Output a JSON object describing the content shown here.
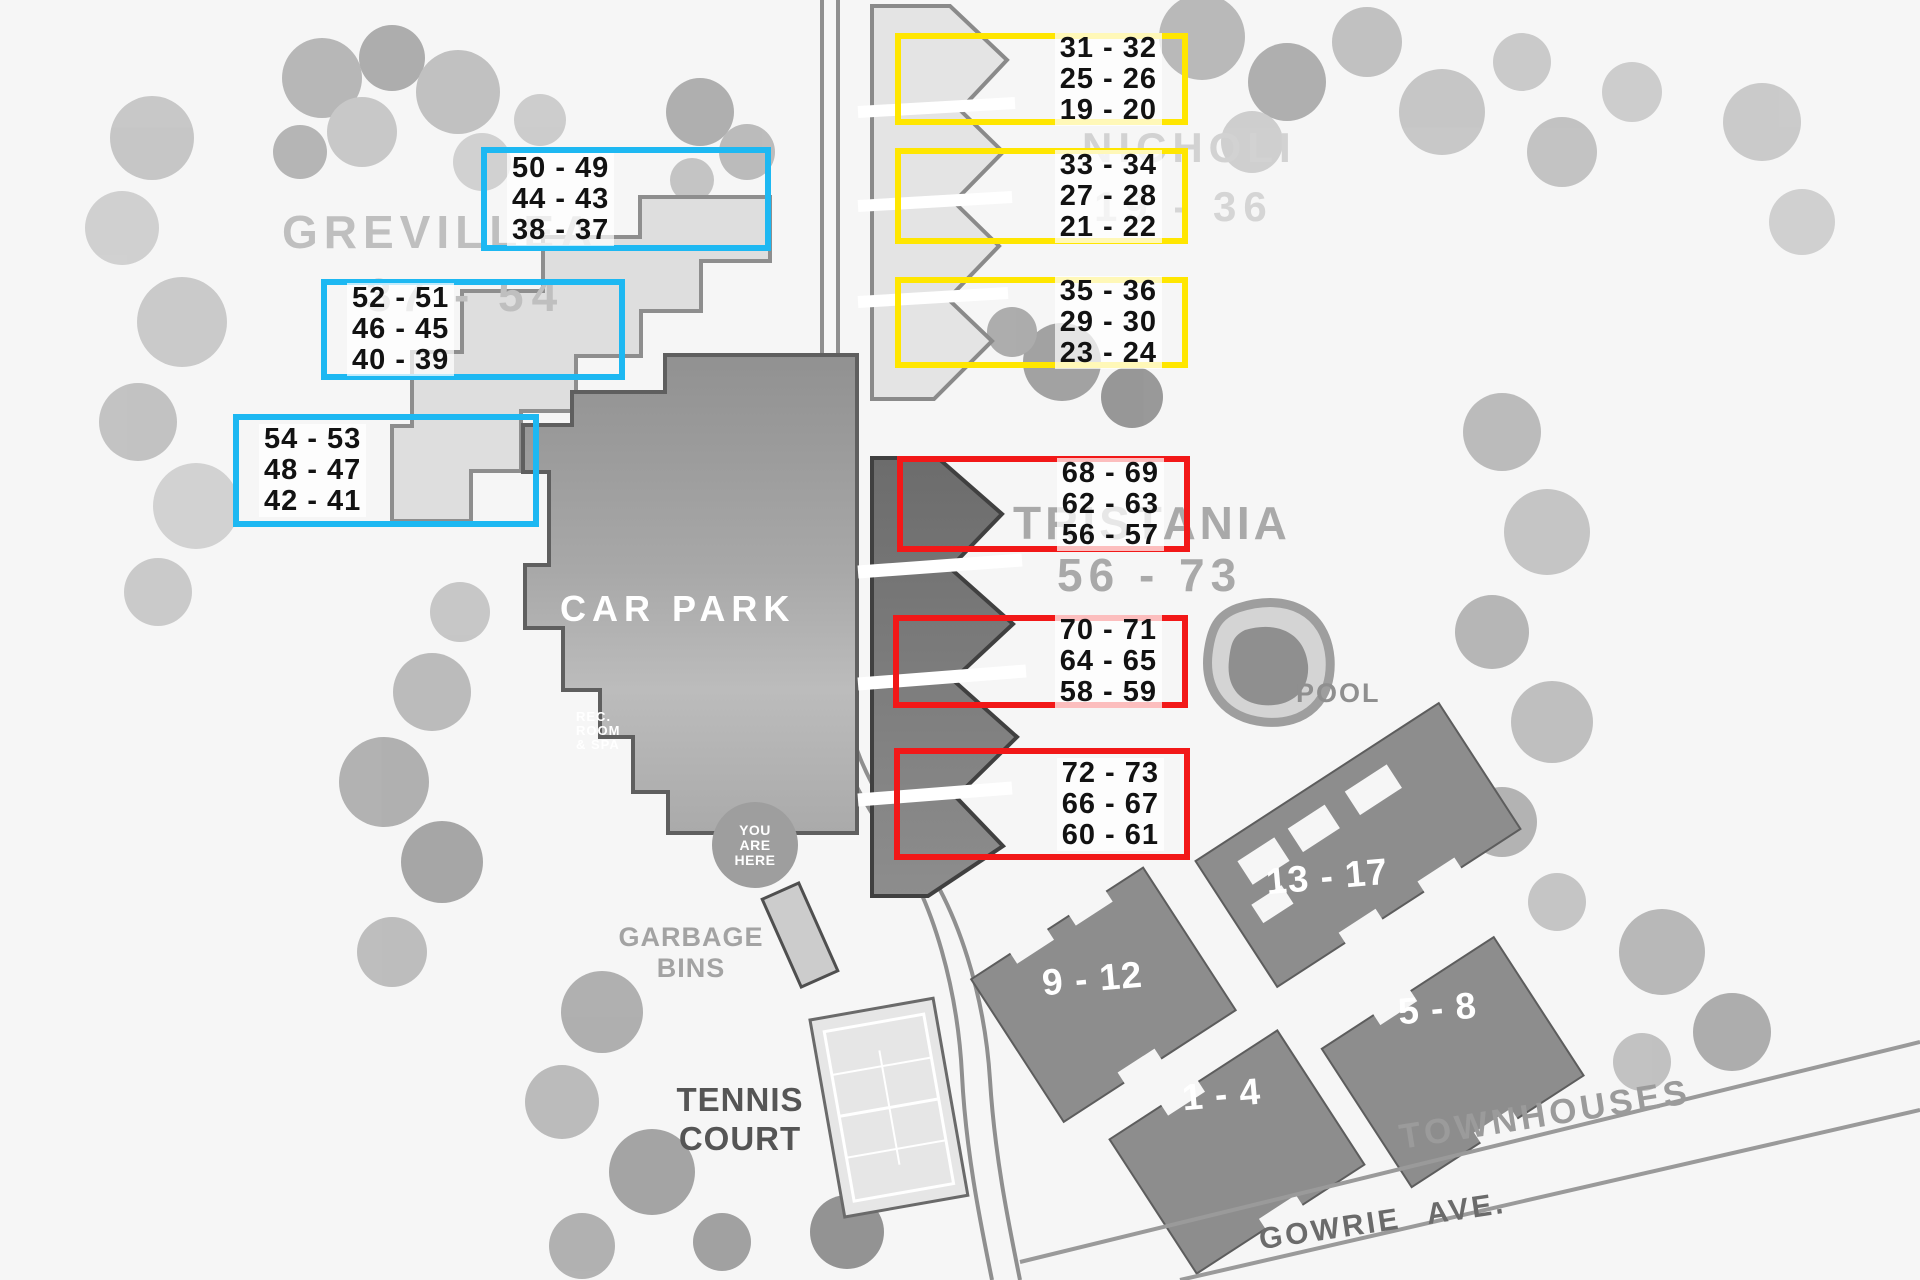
{
  "sections": [
    {
      "id": "grevillea",
      "label": "GREVILLEA",
      "range": "37 - 54",
      "highlight_color": "#1db8f2",
      "boxes": [
        {
          "lines": [
            "50 - 49",
            "44 - 43",
            "38 - 37"
          ]
        },
        {
          "lines": [
            "52 - 51",
            "46 - 45",
            "40 - 39"
          ]
        },
        {
          "lines": [
            "54 - 53",
            "48 - 47",
            "42 - 41"
          ]
        }
      ]
    },
    {
      "id": "nicholi",
      "label": "NICHOLI",
      "range": "19 - 36",
      "highlight_color": "#ffe600",
      "boxes": [
        {
          "lines": [
            "31 - 32",
            "25 - 26",
            "19 - 20"
          ]
        },
        {
          "lines": [
            "33 - 34",
            "27 - 28",
            "21 - 22"
          ]
        },
        {
          "lines": [
            "35 - 36",
            "29 - 30",
            "23 - 24"
          ]
        }
      ]
    },
    {
      "id": "tristania",
      "label": "TRISTANIA",
      "range": "56 - 73",
      "highlight_color": "#f21818",
      "boxes": [
        {
          "lines": [
            "68 - 69",
            "62 - 63",
            "56 - 57"
          ]
        },
        {
          "lines": [
            "70 - 71",
            "64 - 65",
            "58 - 59"
          ]
        },
        {
          "lines": [
            "72 - 73",
            "66 - 67",
            "60 - 61"
          ]
        }
      ]
    }
  ],
  "landmarks": {
    "car_park": "CAR PARK",
    "rec_room": [
      "REC.",
      "ROOM",
      "& SPA"
    ],
    "you_are_here": [
      "YOU",
      "ARE",
      "HERE"
    ],
    "pool": "POOL",
    "garbage_bins": [
      "GARBAGE",
      "BINS"
    ],
    "tennis_court": [
      "TENNIS",
      "COURT"
    ],
    "townhouses": "TOWNHOUSES",
    "street": "GOWRIE AVE."
  },
  "townhouse_blocks": [
    {
      "label": "13 - 17"
    },
    {
      "label": "9 - 12"
    },
    {
      "label": "5 - 8"
    },
    {
      "label": "1 - 4"
    }
  ]
}
